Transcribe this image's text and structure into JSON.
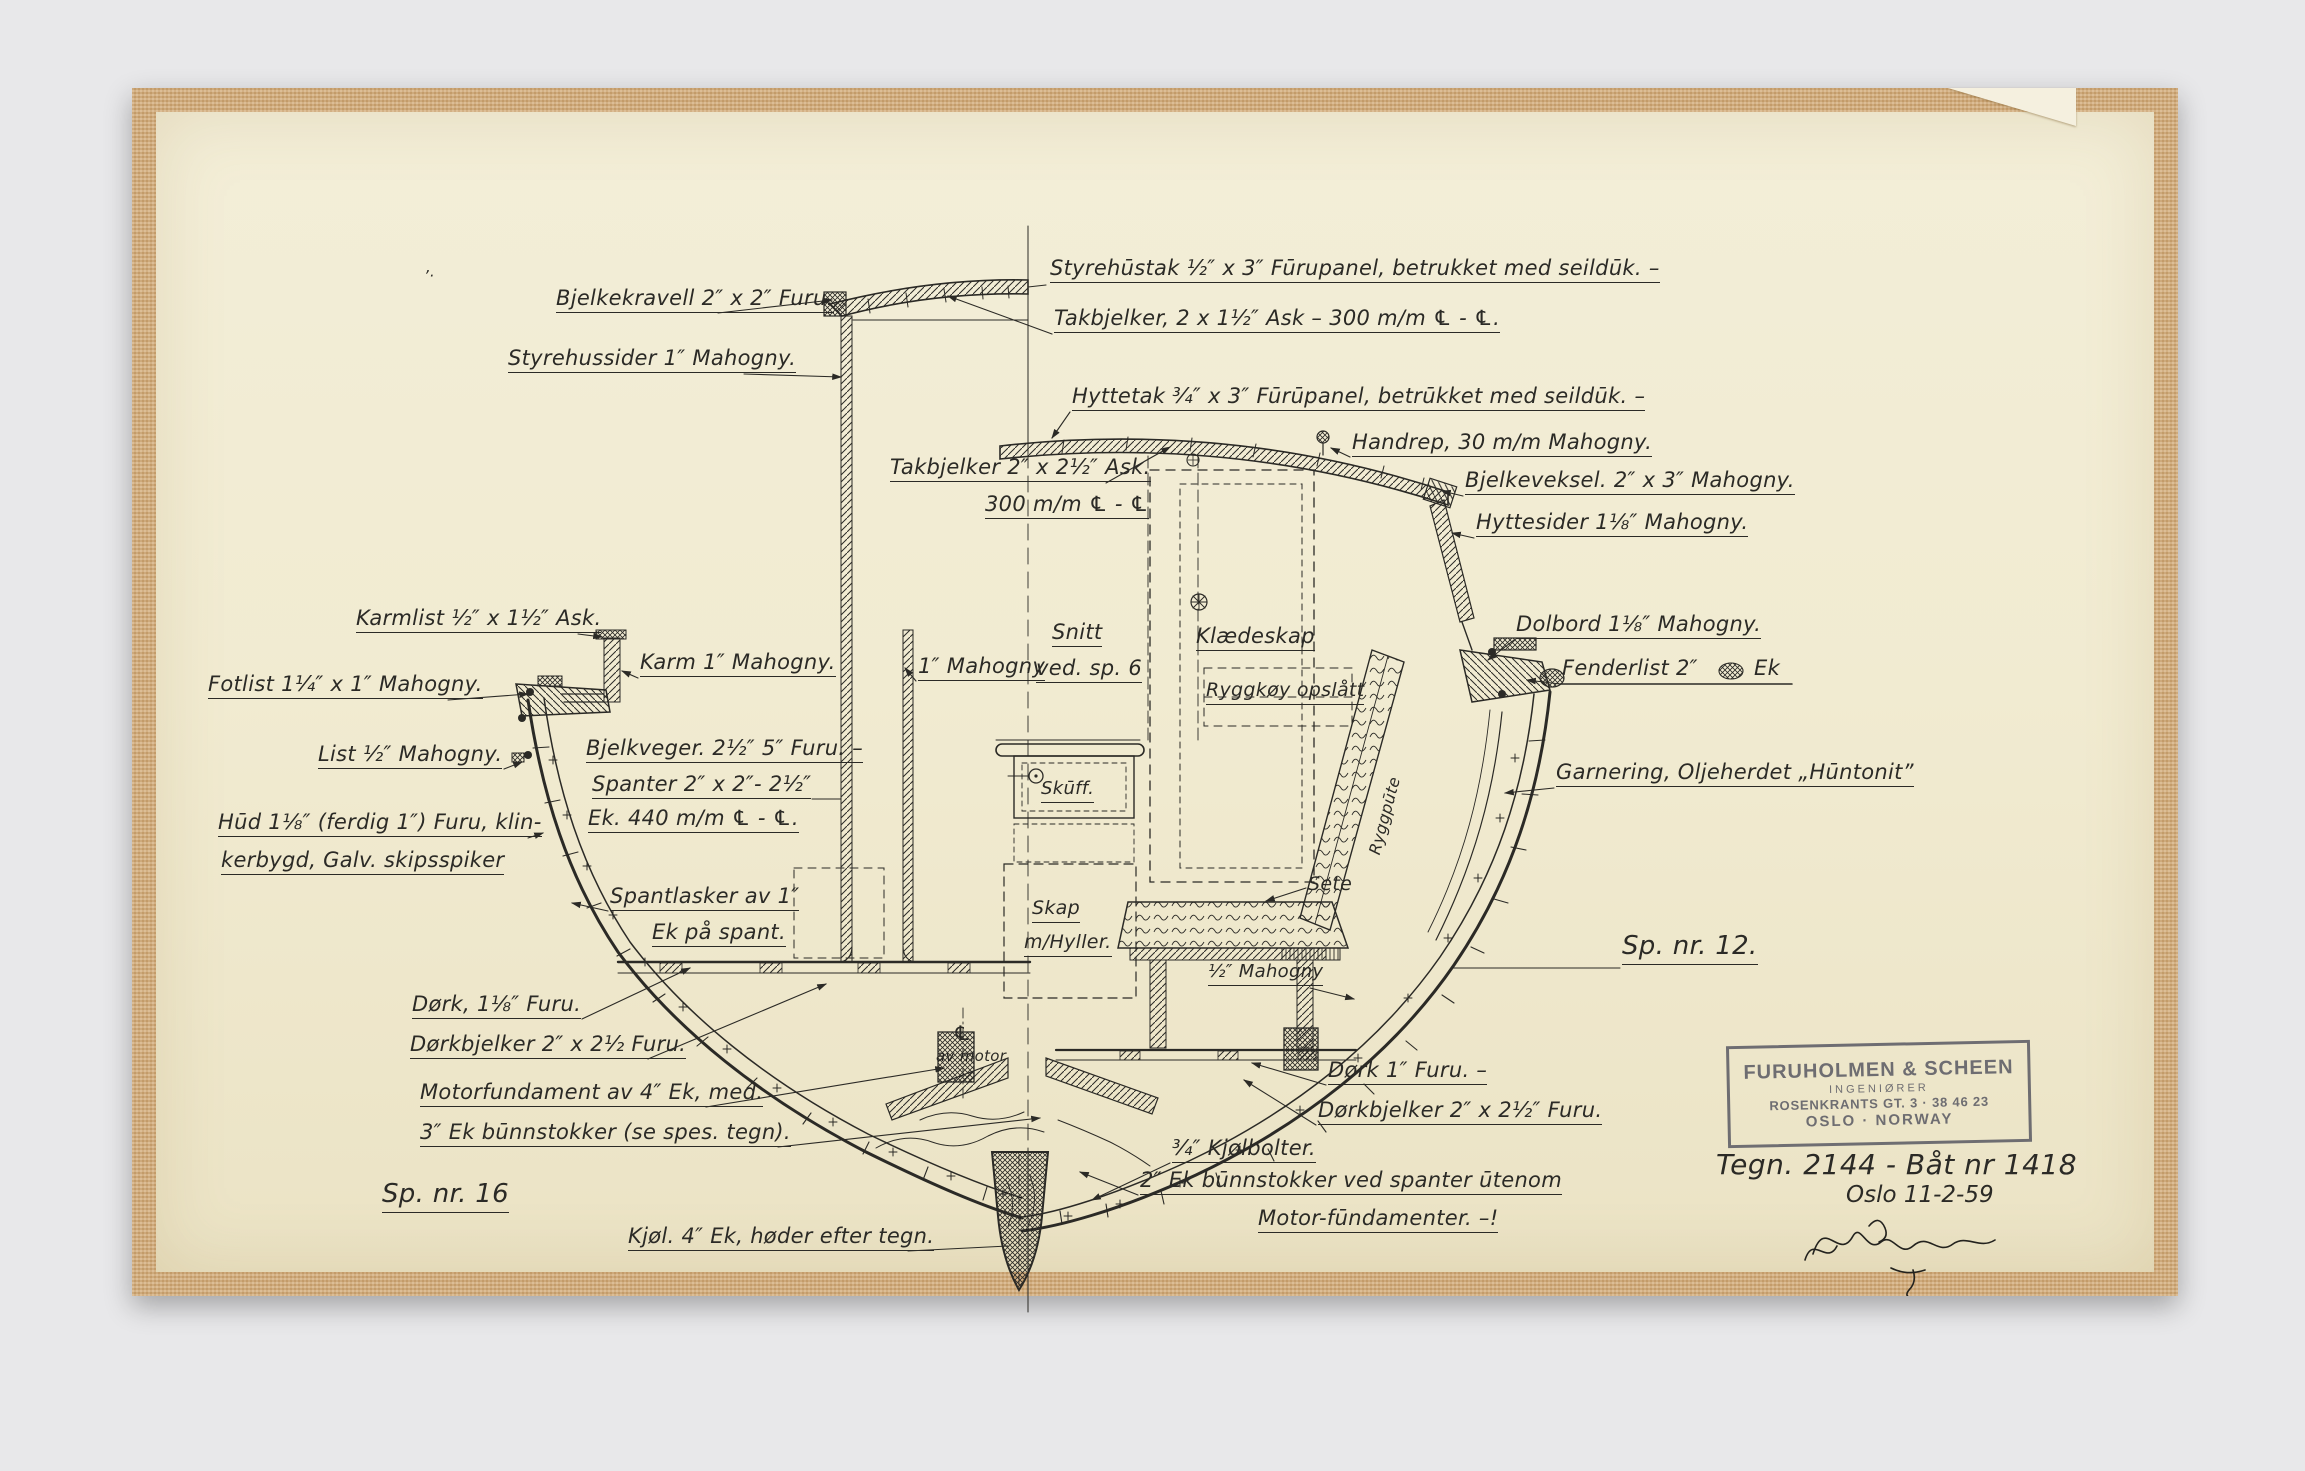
{
  "colors": {
    "page_bg": "#e8e8ea",
    "tape": "#d3ab79",
    "paper": "#f1ebd1",
    "ink": "#2b2a26",
    "stamp_ink": "#5d5d66"
  },
  "stamp": {
    "line1": "FURUHOLMEN & SCHEEN",
    "line2": "INGENIØRER",
    "line3": "ROSENKRANTS GT. 3 · 38 46 23",
    "line4": "OSLO · NORWAY"
  },
  "title_block": {
    "drawing_no": "Tegn. 2144 - Båt nr 1418",
    "date": "Oslo 11-2-59"
  },
  "labels": [
    {
      "id": "styrehustak",
      "text": "Styrehūstak ½″ x 3″ Fūrupanel, betrukket med seildūk. –",
      "x": 1050,
      "y": 256
    },
    {
      "id": "takbjelker-styrehus",
      "text": "Takbjelker, 2 x 1½″ Ask – 300 m/m ℄ - ℄.",
      "x": 1054,
      "y": 306
    },
    {
      "id": "bjelkekravell",
      "text": "Bjelkekravell 2″ x 2″ Furu.",
      "x": 556,
      "y": 286
    },
    {
      "id": "styrehussider",
      "text": "Styrehussider 1″ Mahogny.",
      "x": 508,
      "y": 346
    },
    {
      "id": "hyttetak",
      "text": "Hyttetak ¾″ x 3″ Fūrūpanel, betrūkket med seildūk. –",
      "x": 1072,
      "y": 384
    },
    {
      "id": "handrep",
      "text": "Handrep, 30 m/m Mahogny.",
      "x": 1352,
      "y": 430
    },
    {
      "id": "takbjelker-hytte",
      "text": "Takbjelker 2″ x 2½″ Ask.",
      "x": 890,
      "y": 455
    },
    {
      "id": "cc-300mm",
      "text": "300 m/m ℄ - ℄",
      "x": 985,
      "y": 492
    },
    {
      "id": "bjelkeveksel",
      "text": "Bjelkeveksel. 2″ x 3″ Mahogny.",
      "x": 1465,
      "y": 468
    },
    {
      "id": "hyttesider",
      "text": "Hyttesider 1⅛″ Mahogny.",
      "x": 1476,
      "y": 510
    },
    {
      "id": "karmlist",
      "text": "Karmlist ½″ x 1½″ Ask.",
      "x": 356,
      "y": 606
    },
    {
      "id": "karm",
      "text": "Karm 1″ Mahogny.",
      "x": 640,
      "y": 650
    },
    {
      "id": "mahogny-1in",
      "text": "1″ Mahogny",
      "x": 918,
      "y": 654
    },
    {
      "id": "snitt",
      "text": "Snitt",
      "x": 1052,
      "y": 620
    },
    {
      "id": "ved-sp6",
      "text": "ved. sp. 6",
      "x": 1036,
      "y": 656
    },
    {
      "id": "klaedeskap",
      "text": "Klædeskap",
      "x": 1196,
      "y": 624
    },
    {
      "id": "ryggkoy",
      "text": "Ryggkøy opslått",
      "x": 1206,
      "y": 680,
      "fs": 19
    },
    {
      "id": "dolbord",
      "text": "Dolbord 1⅛″ Mahogny.",
      "x": 1516,
      "y": 612
    },
    {
      "id": "fenderlist",
      "text": "Fenderlist 2″",
      "x": 1562,
      "y": 656,
      "u": false
    },
    {
      "id": "fenderlist-ek",
      "text": "Ek",
      "x": 1754,
      "y": 656,
      "u": false
    },
    {
      "id": "fotlist",
      "text": "Fotlist 1¼″ x 1″ Mahogny.",
      "x": 208,
      "y": 672
    },
    {
      "id": "list",
      "text": "List ½″ Mahogny.",
      "x": 318,
      "y": 742
    },
    {
      "id": "bjelkveger",
      "text": "Bjelkveger. 2½″ 5″ Furu. –",
      "x": 586,
      "y": 736
    },
    {
      "id": "spanter",
      "text": "Spanter 2″ x 2″- 2½″",
      "x": 592,
      "y": 772
    },
    {
      "id": "ek440",
      "text": "Ek. 440 m/m ℄ - ℄.",
      "x": 588,
      "y": 806
    },
    {
      "id": "hud-line1",
      "text": "Hūd 1⅛″ (ferdig 1″) Furu, klin-",
      "x": 218,
      "y": 810
    },
    {
      "id": "hud-line2",
      "text": "kerbygd, Galv. skipsspiker",
      "x": 221,
      "y": 848
    },
    {
      "id": "skuff",
      "text": "Skūff.",
      "x": 1041,
      "y": 779,
      "fs": 18
    },
    {
      "id": "garnering",
      "text": "Garnering, Oljeherdet „Hūntonit”",
      "x": 1556,
      "y": 760
    },
    {
      "id": "spantlasker",
      "text": "Spantlasker av 1″",
      "x": 610,
      "y": 884
    },
    {
      "id": "ek-paa-spant",
      "text": "Ek på spant.",
      "x": 652,
      "y": 920
    },
    {
      "id": "skap",
      "text": "Skap",
      "x": 1032,
      "y": 898,
      "fs": 19
    },
    {
      "id": "m-hyller",
      "text": "m/Hyller.",
      "x": 1024,
      "y": 932,
      "fs": 19
    },
    {
      "id": "sete",
      "text": "Sete",
      "x": 1308,
      "y": 874,
      "fs": 19,
      "u": false
    },
    {
      "id": "ryggpute",
      "text": "Ryggpūte",
      "x": 1366,
      "y": 852,
      "fs": 16,
      "u": false,
      "rot": -75
    },
    {
      "id": "half-mahogny",
      "text": "½″ Mahogny",
      "x": 1208,
      "y": 962,
      "fs": 18
    },
    {
      "id": "sp-nr-12",
      "text": "Sp. nr. 12.",
      "x": 1622,
      "y": 932,
      "fs": 26
    },
    {
      "id": "cl-symbol",
      "text": "℄",
      "x": 953,
      "y": 1022,
      "fs": 20,
      "u": false
    },
    {
      "id": "av-motor",
      "text": "av motor",
      "x": 936,
      "y": 1048,
      "fs": 15,
      "u": false
    },
    {
      "id": "dork-118",
      "text": "Dørk, 1⅛″ Furu.",
      "x": 412,
      "y": 992
    },
    {
      "id": "dorkbjelker-118",
      "text": "Dørkbjelker 2″ x 2½ Furu.",
      "x": 410,
      "y": 1032
    },
    {
      "id": "motorfundament",
      "text": "Motorfundament av 4″ Ek, med.",
      "x": 420,
      "y": 1080
    },
    {
      "id": "ek3-bunnstokker",
      "text": "3″ Ek būnnstokker (se spes. tegn).",
      "x": 420,
      "y": 1120
    },
    {
      "id": "sp-nr-16",
      "text": "Sp. nr. 16",
      "x": 382,
      "y": 1180,
      "fs": 26
    },
    {
      "id": "kjol",
      "text": "Kjøl. 4″ Ek, høder efter tegn.",
      "x": 628,
      "y": 1224
    },
    {
      "id": "dork-1",
      "text": "Dørk 1″ Furu. –",
      "x": 1328,
      "y": 1058
    },
    {
      "id": "dorkbjelker-1",
      "text": "Dørkbjelker 2″ x 2½″ Furu.",
      "x": 1318,
      "y": 1098
    },
    {
      "id": "kjolbolter",
      "text": "¾″ Kjølbolter.",
      "x": 1172,
      "y": 1136
    },
    {
      "id": "ek2-bunnstokker",
      "text": "2″ Ek būnnstokker ved spanter ūtenom",
      "x": 1140,
      "y": 1168
    },
    {
      "id": "motor-fundamenter",
      "text": "Motor-fūndamenter. –!",
      "x": 1258,
      "y": 1206
    },
    {
      "id": "pen-mark",
      "text": "’·",
      "x": 424,
      "y": 268,
      "fs": 15,
      "u": false
    }
  ]
}
